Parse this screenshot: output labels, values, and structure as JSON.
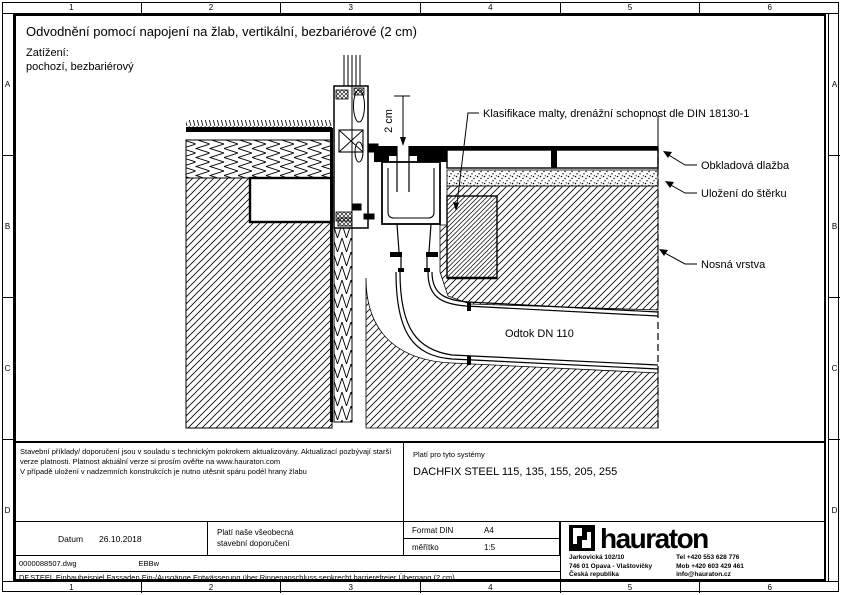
{
  "frame": {
    "cols": [
      "1",
      "2",
      "3",
      "4",
      "5",
      "6"
    ],
    "rows": [
      "A",
      "B",
      "C",
      "D"
    ]
  },
  "header": {
    "title": "Odvodnění pomocí napojení na žlab, vertikální, bezbariérové (2 cm)",
    "load_label": "Zatížení:",
    "load_value": "pochozí, bezbariérový"
  },
  "drawing": {
    "labels": {
      "mortar_note": "Klasifikace malty, drenážní schopnost dle DIN 18130-1",
      "tile": "Obkladová dlažba",
      "bedding": "Uložení do štěrku",
      "base": "Nosná vrstva",
      "outlet": "Odtok DN 110",
      "dimension": "2 cm"
    }
  },
  "titleblock": {
    "notes": {
      "line1": "Stavební příklady/ doporučení jsou v souladu s technickým pokrokem aktualizovány. Aktualizací pozbývají starší",
      "line2": "verze platnosti. Platnost aktuální verze si prosím ověřte na www.hauraton.com",
      "line3": "V případě uložení v nadzemních konstrukcích je nutno utěsnit spáru podél hrany žlabu"
    },
    "systems": {
      "label": "Platí pro tyto systémy",
      "value": "DACHFIX STEEL 115, 135, 155, 205, 255"
    },
    "date": {
      "label": "Datum",
      "value": "26.10.2018"
    },
    "recommend": {
      "line1": "Platí naše všeobecná",
      "line2": "stavební doporučení"
    },
    "format": {
      "label": "Format DIN",
      "value": "A4"
    },
    "scale": {
      "label": "měřítko",
      "value": "1:5"
    },
    "file": {
      "name": "0000088507.dwg",
      "author": "EBBw"
    },
    "description": "DF.STEEL Einbaubeispiel Fassaden Ein-/Ausgänge Entwässerung über Rinnenanschluss senkrecht barrierefreier Übergang (2 cm)",
    "brand": {
      "wordmark": "hauraton",
      "address1": "Jarkovická 102/10",
      "address2": "746 01 Opava - Vlaštovičky",
      "address3": "Česká republika",
      "tel": "Tel +420 553 628 776",
      "mob": "Mob +420 603 429 461",
      "email": "info@hauraton.cz"
    }
  }
}
